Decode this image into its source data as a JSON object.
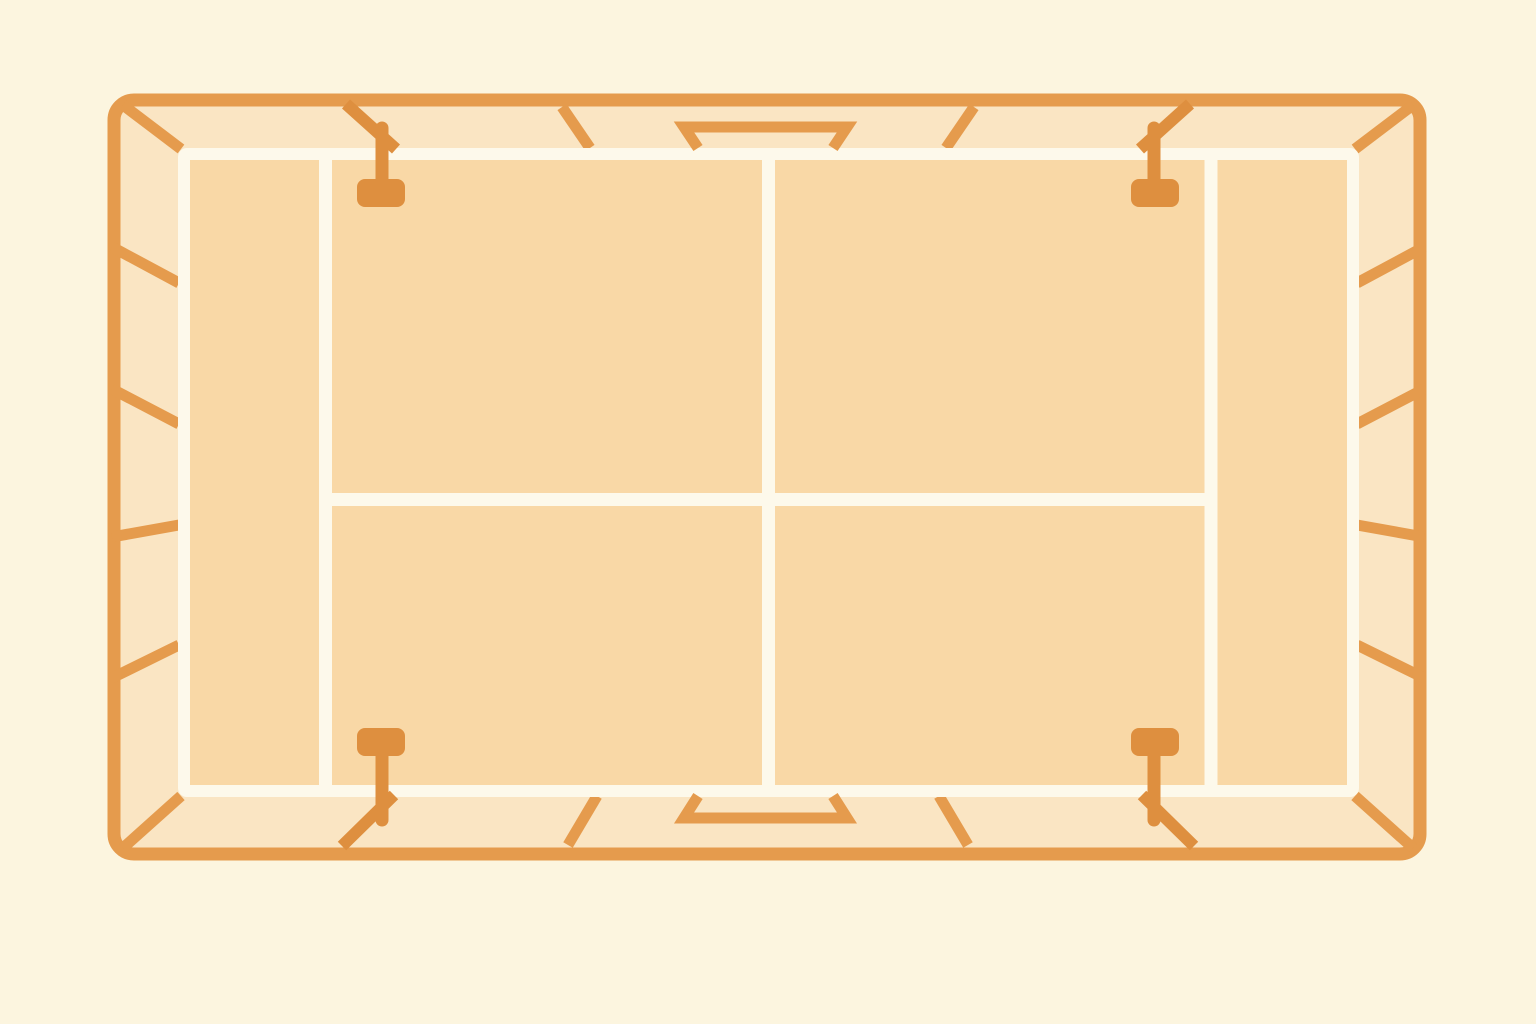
{
  "scene": {
    "label": "Top-down illustration of a stadium court with seating ring, floodlights and tunnels",
    "canvas": {
      "width": 1536,
      "height": 1024
    }
  },
  "colors": {
    "background": "#FCF5DF",
    "seating_ring": "#FAE5C3",
    "court_fill": "#F9D8A6",
    "court_line": "#FDF9EB",
    "wall_orange": "#E59B4D",
    "fixture_orange": "#DE8F3F"
  },
  "wall": {
    "x": 114,
    "y": 100,
    "w": 1306,
    "h": 754,
    "rx": 20,
    "stroke_w": 13
  },
  "court": {
    "x": 184,
    "y": 154,
    "w": 1169,
    "h": 637,
    "rx": 3,
    "stroke_w": 12
  },
  "court_lines": [
    {
      "name": "court-line-left-alley",
      "x1": 325.5,
      "y1": 154,
      "x2": 325.5,
      "y2": 791
    },
    {
      "name": "court-line-right-alley",
      "x1": 1211,
      "y1": 154,
      "x2": 1211,
      "y2": 791
    },
    {
      "name": "court-line-center-vertical",
      "x1": 768.5,
      "y1": 154,
      "x2": 768.5,
      "y2": 791
    },
    {
      "name": "court-line-center-horizontal",
      "x1": 325.5,
      "y1": 499.5,
      "x2": 1211,
      "y2": 499.5
    }
  ],
  "corner_dividers": [
    {
      "name": "corner-divider-top-left",
      "x1": 123,
      "y1": 105,
      "x2": 181,
      "y2": 149
    },
    {
      "name": "corner-divider-top-right",
      "x1": 1413,
      "y1": 105,
      "x2": 1355,
      "y2": 149
    },
    {
      "name": "corner-divider-bottom-left",
      "x1": 123,
      "y1": 848,
      "x2": 181,
      "y2": 796
    },
    {
      "name": "corner-divider-bottom-right",
      "x1": 1413,
      "y1": 848,
      "x2": 1355,
      "y2": 796
    }
  ],
  "seating_dividers": [
    {
      "name": "seating-divider-left-1",
      "x1": 112,
      "y1": 247,
      "x2": 179,
      "y2": 283
    },
    {
      "name": "seating-divider-left-2",
      "x1": 112,
      "y1": 389,
      "x2": 179,
      "y2": 424
    },
    {
      "name": "seating-divider-left-3",
      "x1": 112,
      "y1": 537,
      "x2": 179,
      "y2": 525
    },
    {
      "name": "seating-divider-left-4",
      "x1": 112,
      "y1": 678,
      "x2": 179,
      "y2": 645
    },
    {
      "name": "seating-divider-right-1",
      "x1": 1424,
      "y1": 247,
      "x2": 1357,
      "y2": 283
    },
    {
      "name": "seating-divider-right-2",
      "x1": 1424,
      "y1": 389,
      "x2": 1357,
      "y2": 424
    },
    {
      "name": "seating-divider-right-3",
      "x1": 1424,
      "y1": 537,
      "x2": 1357,
      "y2": 525
    },
    {
      "name": "seating-divider-right-4",
      "x1": 1424,
      "y1": 678,
      "x2": 1357,
      "y2": 645
    },
    {
      "name": "seating-divider-top-left",
      "x1": 562,
      "y1": 107,
      "x2": 590,
      "y2": 148
    },
    {
      "name": "seating-divider-top-right",
      "x1": 974,
      "y1": 107,
      "x2": 946,
      "y2": 148
    },
    {
      "name": "seating-divider-bottom-left",
      "x1": 597,
      "y1": 796,
      "x2": 568,
      "y2": 845
    },
    {
      "name": "seating-divider-bottom-right",
      "x1": 939,
      "y1": 796,
      "x2": 968,
      "y2": 845
    }
  ],
  "tunnels": [
    {
      "name": "tunnel-top",
      "points": "698,148 684,127 847,127 833,148"
    },
    {
      "name": "tunnel-bottom",
      "points": "698,796 684,818 847,818 833,796"
    }
  ],
  "floodlights": [
    {
      "name": "floodlight-top-left",
      "arm": {
        "x1": 346,
        "y1": 104,
        "x2": 396,
        "y2": 149
      },
      "stem": {
        "x1": 382,
        "y1": 128,
        "x2": 382,
        "y2": 188
      },
      "post": {
        "x": 357,
        "y": 179,
        "w": 48,
        "h": 28,
        "rx": 8
      }
    },
    {
      "name": "floodlight-top-right",
      "arm": {
        "x1": 1190,
        "y1": 104,
        "x2": 1140,
        "y2": 149
      },
      "stem": {
        "x1": 1154,
        "y1": 128,
        "x2": 1154,
        "y2": 188
      },
      "post": {
        "x": 1131,
        "y": 179,
        "w": 48,
        "h": 28,
        "rx": 8
      }
    },
    {
      "name": "floodlight-bottom-left",
      "arm": {
        "x1": 394,
        "y1": 795,
        "x2": 342,
        "y2": 846
      },
      "stem": {
        "x1": 382,
        "y1": 748,
        "x2": 382,
        "y2": 820
      },
      "post": {
        "x": 357,
        "y": 728,
        "w": 48,
        "h": 28,
        "rx": 8
      }
    },
    {
      "name": "floodlight-bottom-right",
      "arm": {
        "x1": 1142,
        "y1": 795,
        "x2": 1194,
        "y2": 846
      },
      "stem": {
        "x1": 1154,
        "y1": 748,
        "x2": 1154,
        "y2": 820
      },
      "post": {
        "x": 1131,
        "y": 728,
        "w": 48,
        "h": 28,
        "rx": 8
      }
    }
  ],
  "stroke_widths": {
    "divider": 11,
    "tunnel": 11,
    "arm": 12,
    "stem": 13
  }
}
